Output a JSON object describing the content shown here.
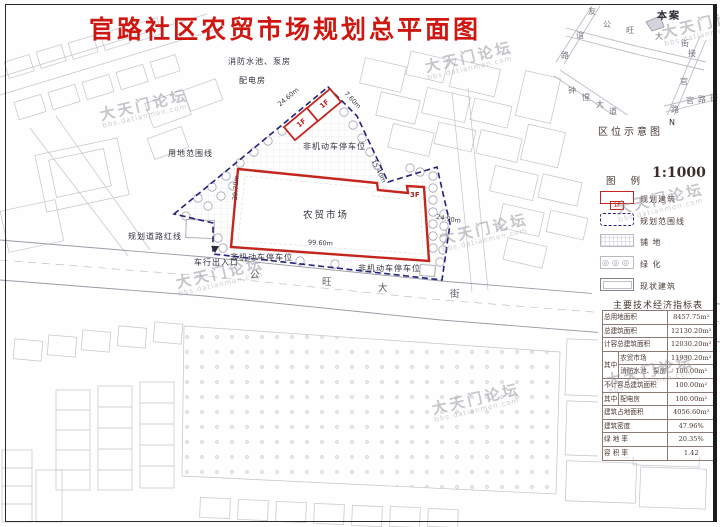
{
  "title": "官路社区农贸市场规划总平面图",
  "watermark": {
    "name": "大天门论坛",
    "url": "bbs.datianmen.com"
  },
  "plan": {
    "labels": {
      "fire_pump": "消防水池、泵房",
      "power_room": "配电房",
      "site_boundary": "用地范围线",
      "road_redline": "规划道路红线",
      "entrance": "车行出入口",
      "entrance_arrow": "∨",
      "parking_top": "非机动车停车位",
      "parking_bottom_left": "非机动车停车位",
      "parking_bottom_right": "非机动车停车位",
      "market": "农贸市场",
      "market_floor": "3F",
      "aux1_floor": "1F",
      "aux2_floor": "1F"
    },
    "dimensions": {
      "top_left": "24.60m",
      "top_right": "7.60m",
      "right_upper": "15.40m",
      "right_side": "24.90m",
      "building_width": "99.60m",
      "building_depth": "39.70m"
    },
    "street": [
      "公",
      "旺",
      "大",
      "街"
    ]
  },
  "location_map": {
    "title": "区位示意图",
    "north_label": "N",
    "site_marker": "本案",
    "roads": {
      "youyi": [
        "友",
        "谊",
        "路"
      ],
      "gongwang": [
        "公",
        "旺",
        "大",
        "街"
      ],
      "jieguan": [
        "接",
        "官",
        "路"
      ],
      "guanlu": [
        "官",
        "路",
        "街"
      ],
      "zhongxing": [
        "钟",
        "惺",
        "大",
        "道"
      ]
    }
  },
  "legend": {
    "title": "图 例",
    "scale": "1:1000",
    "items": [
      {
        "label": "规划建筑",
        "mark": "1F"
      },
      {
        "label": "规划范围线"
      },
      {
        "label": "铺 地"
      },
      {
        "label": "绿 化"
      },
      {
        "label": "现状建筑"
      }
    ]
  },
  "indicators": {
    "title": "主要技术经济指标表",
    "rows": [
      {
        "label": "总用地面积",
        "value": "8457.75m²"
      },
      {
        "label": "总建筑面积",
        "value": "12130.20m²"
      },
      {
        "label": "计容总建筑面积",
        "value": "12030.20m²"
      },
      {
        "group": "其中",
        "label": "农贸市场",
        "value": "11930.20m²"
      },
      {
        "label": "消防水池、泵房",
        "value": "100.00m²"
      },
      {
        "label": "不计容总建筑面积",
        "value": "100.00m²"
      },
      {
        "group": "其中",
        "label": "配电房",
        "value": "100.00m²"
      },
      {
        "label": "建筑占地面积",
        "value": "4056.60m²"
      },
      {
        "label": "建筑密度",
        "value": "47.96%"
      },
      {
        "label": "绿 地 率",
        "value": "20.35%"
      },
      {
        "label": "容 积 率",
        "value": "1.42"
      }
    ]
  }
}
